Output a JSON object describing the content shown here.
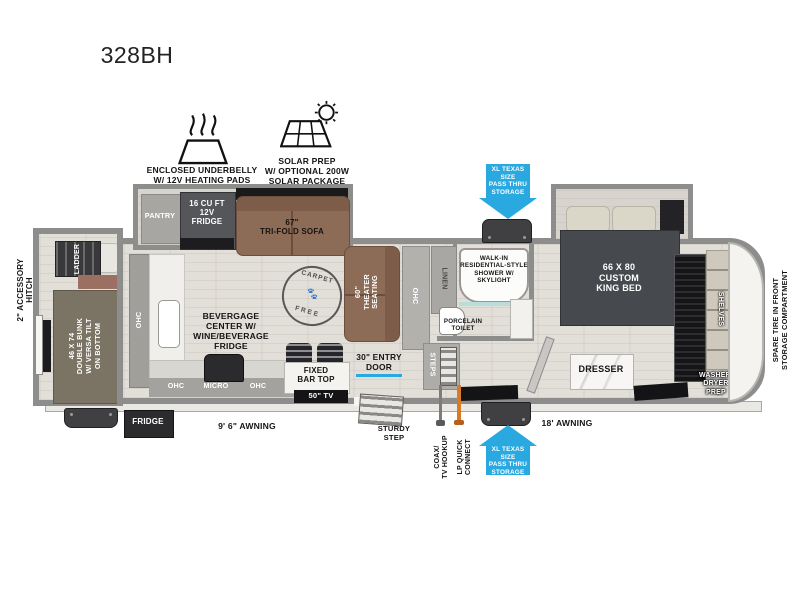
{
  "title": "328BH",
  "colors": {
    "accent_blue": "#29a9e0",
    "wall_gray": "#8d8d8b",
    "sofa_brown": "#8d6c57",
    "bed_gray": "#46494d",
    "bunk_tan": "#7b7465",
    "lp_orange": "#d97a26"
  },
  "features": {
    "underbelly": "ENCLOSED UNDERBELLY\nW/ 12V HEATING PADS",
    "solar": "SOLAR PREP\nW/ OPTIONAL 200W\nSOLAR PACKAGE"
  },
  "exterior": {
    "hitch": "2\" ACCESSORY\nHITCH",
    "spare_tire": "SPARE TIRE IN FRONT\nSTORAGE COMPARTMENT",
    "fridge": "FRIDGE",
    "awning_rear": "9' 6\" AWNING",
    "awning_front": "18' AWNING",
    "sturdy_step": "STURDY\nSTEP",
    "coax": "COAX/\nTV HOOKUP",
    "lp_quick_connect": "LP QUICK\nCONNECT",
    "pass_thru": "XL TEXAS SIZE\nPASS THRU\nSTORAGE"
  },
  "bunk_room": {
    "ladder": "LADDER",
    "bunk": "46 X 74\nDOUBLE BUNK\nW/ VERSA TILT\nON BOTTOM"
  },
  "kitchen": {
    "pantry": "PANTRY",
    "fridge_12v": "16 CU FT\n12V\nFRIDGE",
    "sofa": "67\"\nTRI-FOLD SOFA",
    "ohc_left": "OHC",
    "ohc_a": "OHC",
    "micro": "MICRO",
    "ohc_b": "OHC",
    "beverage_center": "BEVERGAGE\nCENTER W/\nWINE/BEVERAGE\nFRIDGE",
    "bar_top": "FIXED\nBAR TOP",
    "tv": "50\" TV",
    "carpet_free_top": "CARPET",
    "carpet_free_bottom": "FREE",
    "paws": "🐾"
  },
  "living": {
    "theater": "60\"\nTHEATER\nSEATING",
    "ohc": "OHC",
    "entry_door": "30\" ENTRY\nDOOR"
  },
  "bath": {
    "linen": "LINEN",
    "shower": "WALK-IN\nRESIDENTIAL-STYLE\nSHOWER W/\nSKYLIGHT",
    "toilet": "PORCELAIN\nTOILET",
    "steps": "STEPS"
  },
  "bedroom": {
    "bed": "66 X 80\nCUSTOM\nKING BED",
    "dresser": "DRESSER",
    "shelves": "SHELVES",
    "washer_dryer": "WASHER/\nDRYER\nPREP"
  }
}
